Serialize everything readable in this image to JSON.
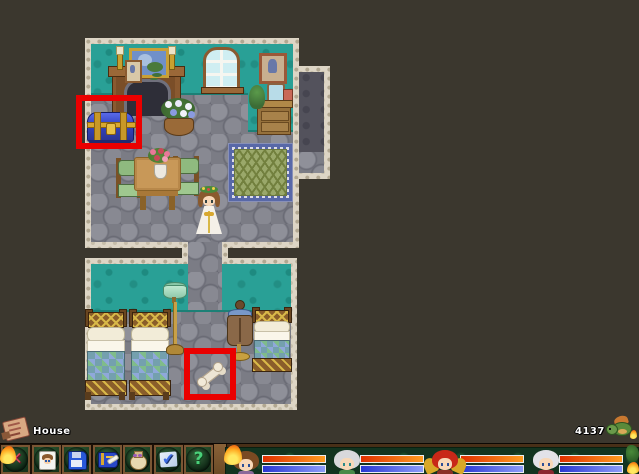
{
  "hud": {
    "map_label": "House",
    "money": "4137"
  },
  "toolbar": {
    "buttons": [
      {
        "icon": "close-icon",
        "glyph": "✕"
      },
      {
        "icon": "status-icon"
      },
      {
        "icon": "save-icon"
      },
      {
        "icon": "quest-log-icon"
      },
      {
        "icon": "inventory-bag-icon"
      },
      {
        "icon": "checkbox-icon",
        "glyph": "✔"
      },
      {
        "icon": "help-icon",
        "glyph": "?"
      }
    ]
  },
  "party": {
    "members": [
      {
        "id": "member-1",
        "hp_fill": "100%",
        "mp_fill": "100%",
        "targeted_flame": true
      },
      {
        "id": "member-2",
        "hp_fill": "100%",
        "mp_fill": "100%",
        "targeted_flame": false
      },
      {
        "id": "member-3",
        "hp_fill": "100%",
        "mp_fill": "100%",
        "targeted_flame": false
      },
      {
        "id": "member-4",
        "hp_fill": "100%",
        "mp_fill": "100%",
        "targeted_flame": false
      }
    ]
  },
  "map": {
    "name": "House",
    "highlights": [
      {
        "target": "treasure-chest"
      },
      {
        "target": "bone-item"
      }
    ]
  },
  "colors": {
    "highlight": "#ea0000",
    "hp-left": "#e03000",
    "hp-right": "#ff9c20",
    "mp-left": "#2837d2",
    "mp-right": "#8d9cf8",
    "teal": "#29a096",
    "floor": "#7b7c85",
    "trim": "#ddd5c5",
    "bg": "#3b372e"
  }
}
